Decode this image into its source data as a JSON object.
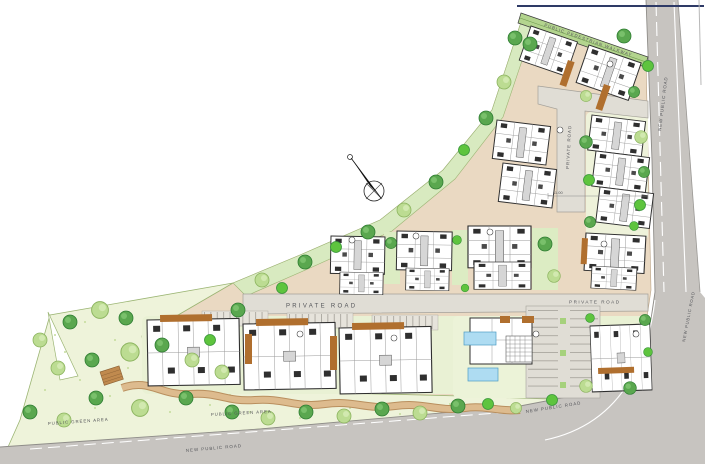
{
  "labels": {
    "pedestrian_walkway": "PUBLIC PEDESTRIAN WALKWAY",
    "new_public_road": "NEW PUBLIC ROAD",
    "private_road": "PRIVATE ROAD",
    "public_green_area": "PUBLIC GREEN AREA",
    "dimension": "11.00"
  },
  "colors": {
    "paving": "#ead9c2",
    "public_road": "#c7c4c0",
    "private_road": "#e0ddd5",
    "green_area": "#eef3da",
    "garden": "#e9f1d4",
    "tree_dark": "#5aa74f",
    "tree_light": "#bcdc92",
    "tree_bright": "#5ec43e",
    "building": "#ffffff",
    "building_line": "#2f2f2f",
    "pergola": "#b06f2e",
    "pool": "#aedcf2",
    "walkway_strip": "#b3d48e",
    "footpath": "#ddbb8e",
    "boundary_line": "#2e3a66",
    "label_text": "#55565a"
  },
  "icons": {
    "north_arrow": "north-arrow"
  }
}
